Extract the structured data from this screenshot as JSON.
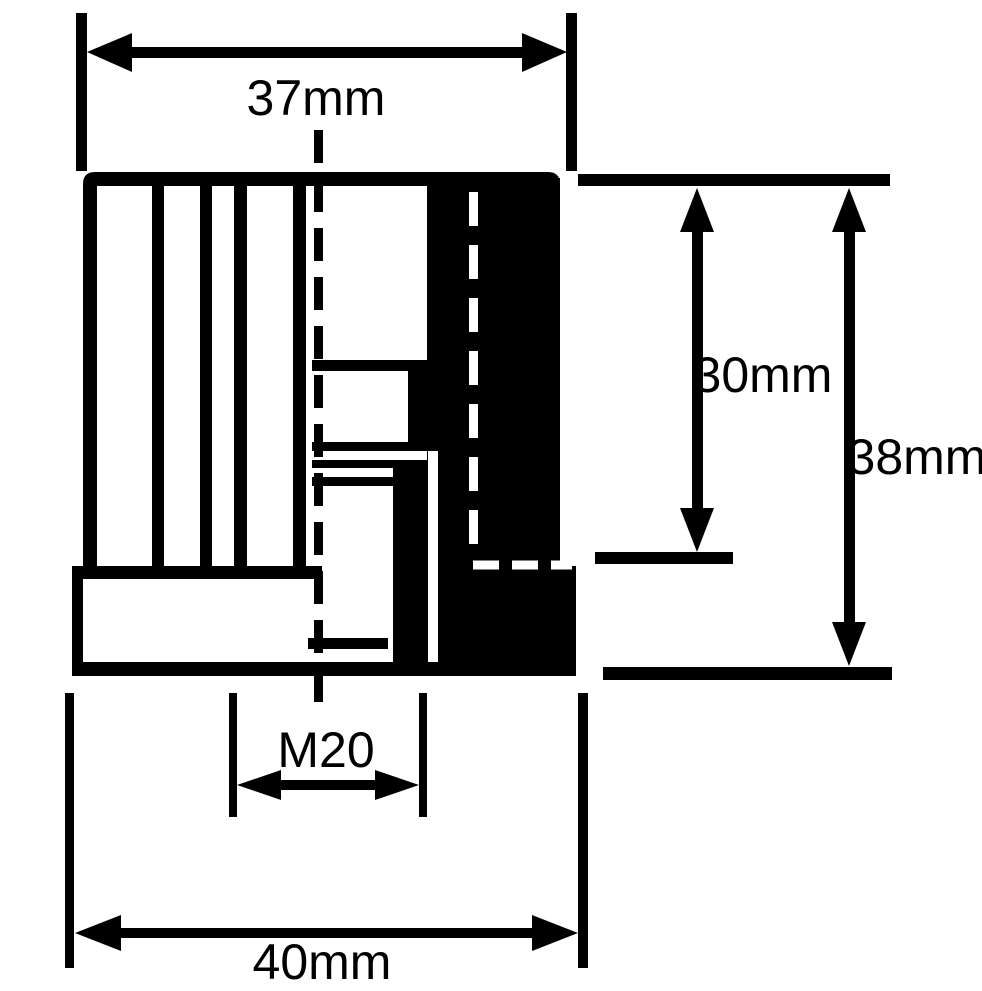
{
  "dimensions": {
    "top_width_label": "37mm",
    "insert_depth_label": "30mm",
    "overall_height_label": "38mm",
    "thread_label": "M20",
    "flange_width_label": "40mm"
  },
  "colors": {
    "ink": "#000000",
    "background": "#ffffff"
  }
}
